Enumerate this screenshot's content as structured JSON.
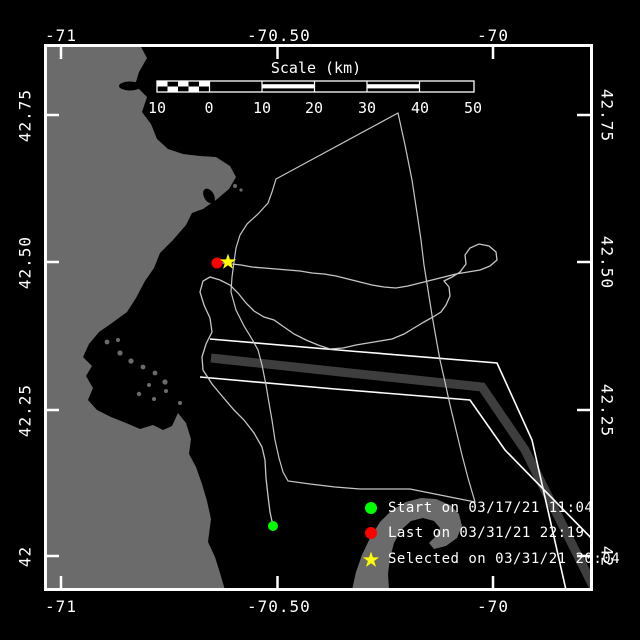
{
  "figure": {
    "background": "#000000",
    "frame_color": "#ffffff"
  },
  "axes": {
    "lon_labels": [
      "-71",
      "-70.50",
      "-70"
    ],
    "lat_labels": [
      "42.75",
      "42.50",
      "42.25",
      "42"
    ]
  },
  "scalebar": {
    "title": "Scale (km)",
    "ticks": [
      "10",
      "0",
      "10",
      "20",
      "30",
      "40",
      "50"
    ]
  },
  "legend": {
    "entries": [
      {
        "marker": "circle",
        "color": "#00ff00",
        "label": "Start on 03/17/21 11:04"
      },
      {
        "marker": "circle",
        "color": "#ff0000",
        "label": "Last on 03/31/21 22:19"
      },
      {
        "marker": "star",
        "color": "#ffff00",
        "label": "Selected on 03/31/21 20:04"
      }
    ]
  },
  "markers": {
    "start": {
      "color": "#00ff00"
    },
    "last": {
      "color": "#ff0000"
    },
    "selected": {
      "color": "#ffff00"
    }
  },
  "map": {
    "land_color": "#6b6b6b",
    "shipping_lane_color": "#3e3e3e",
    "lane_border_color": "#ffffff",
    "track_color": "#c6c6c6",
    "boundary_color": "#c6c6c6"
  }
}
